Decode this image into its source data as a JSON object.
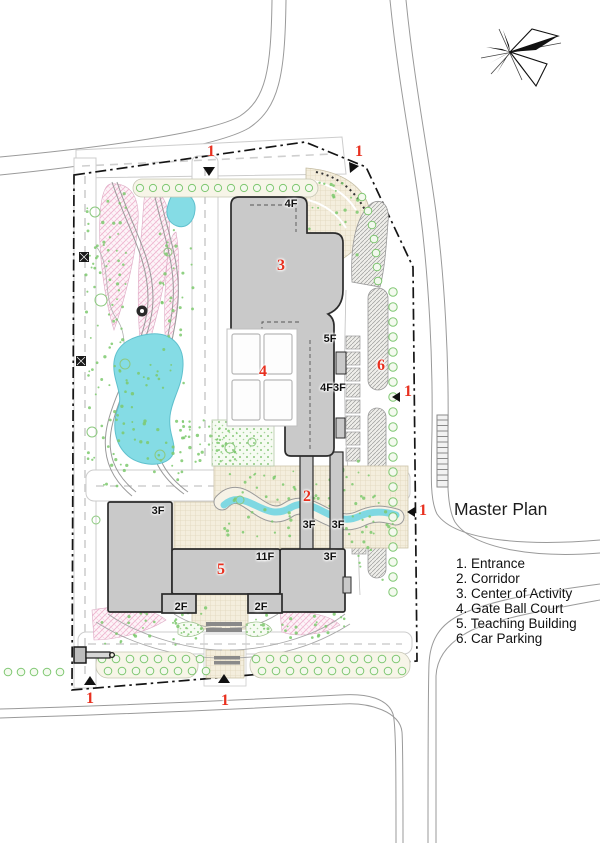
{
  "title": "Master Plan",
  "legend": [
    "1. Entrance",
    "2. Corridor",
    "3. Center of Activity",
    "4. Gate Ball Court",
    "5. Teaching Building",
    "6. Car Parking"
  ],
  "markers": {
    "n1": "1",
    "n2": "2",
    "n3": "3",
    "n4": "4",
    "n5": "5",
    "n6": "6"
  },
  "floors": {
    "f2": "2F",
    "f3": "3F",
    "f4": "4F",
    "f5": "5F",
    "f11": "11F",
    "f4f3f": "4F3F"
  },
  "colors": {
    "red_marker": "#e8301f",
    "water": "#85dce5",
    "building": "#c9c9c9",
    "boundary": "#141414"
  }
}
